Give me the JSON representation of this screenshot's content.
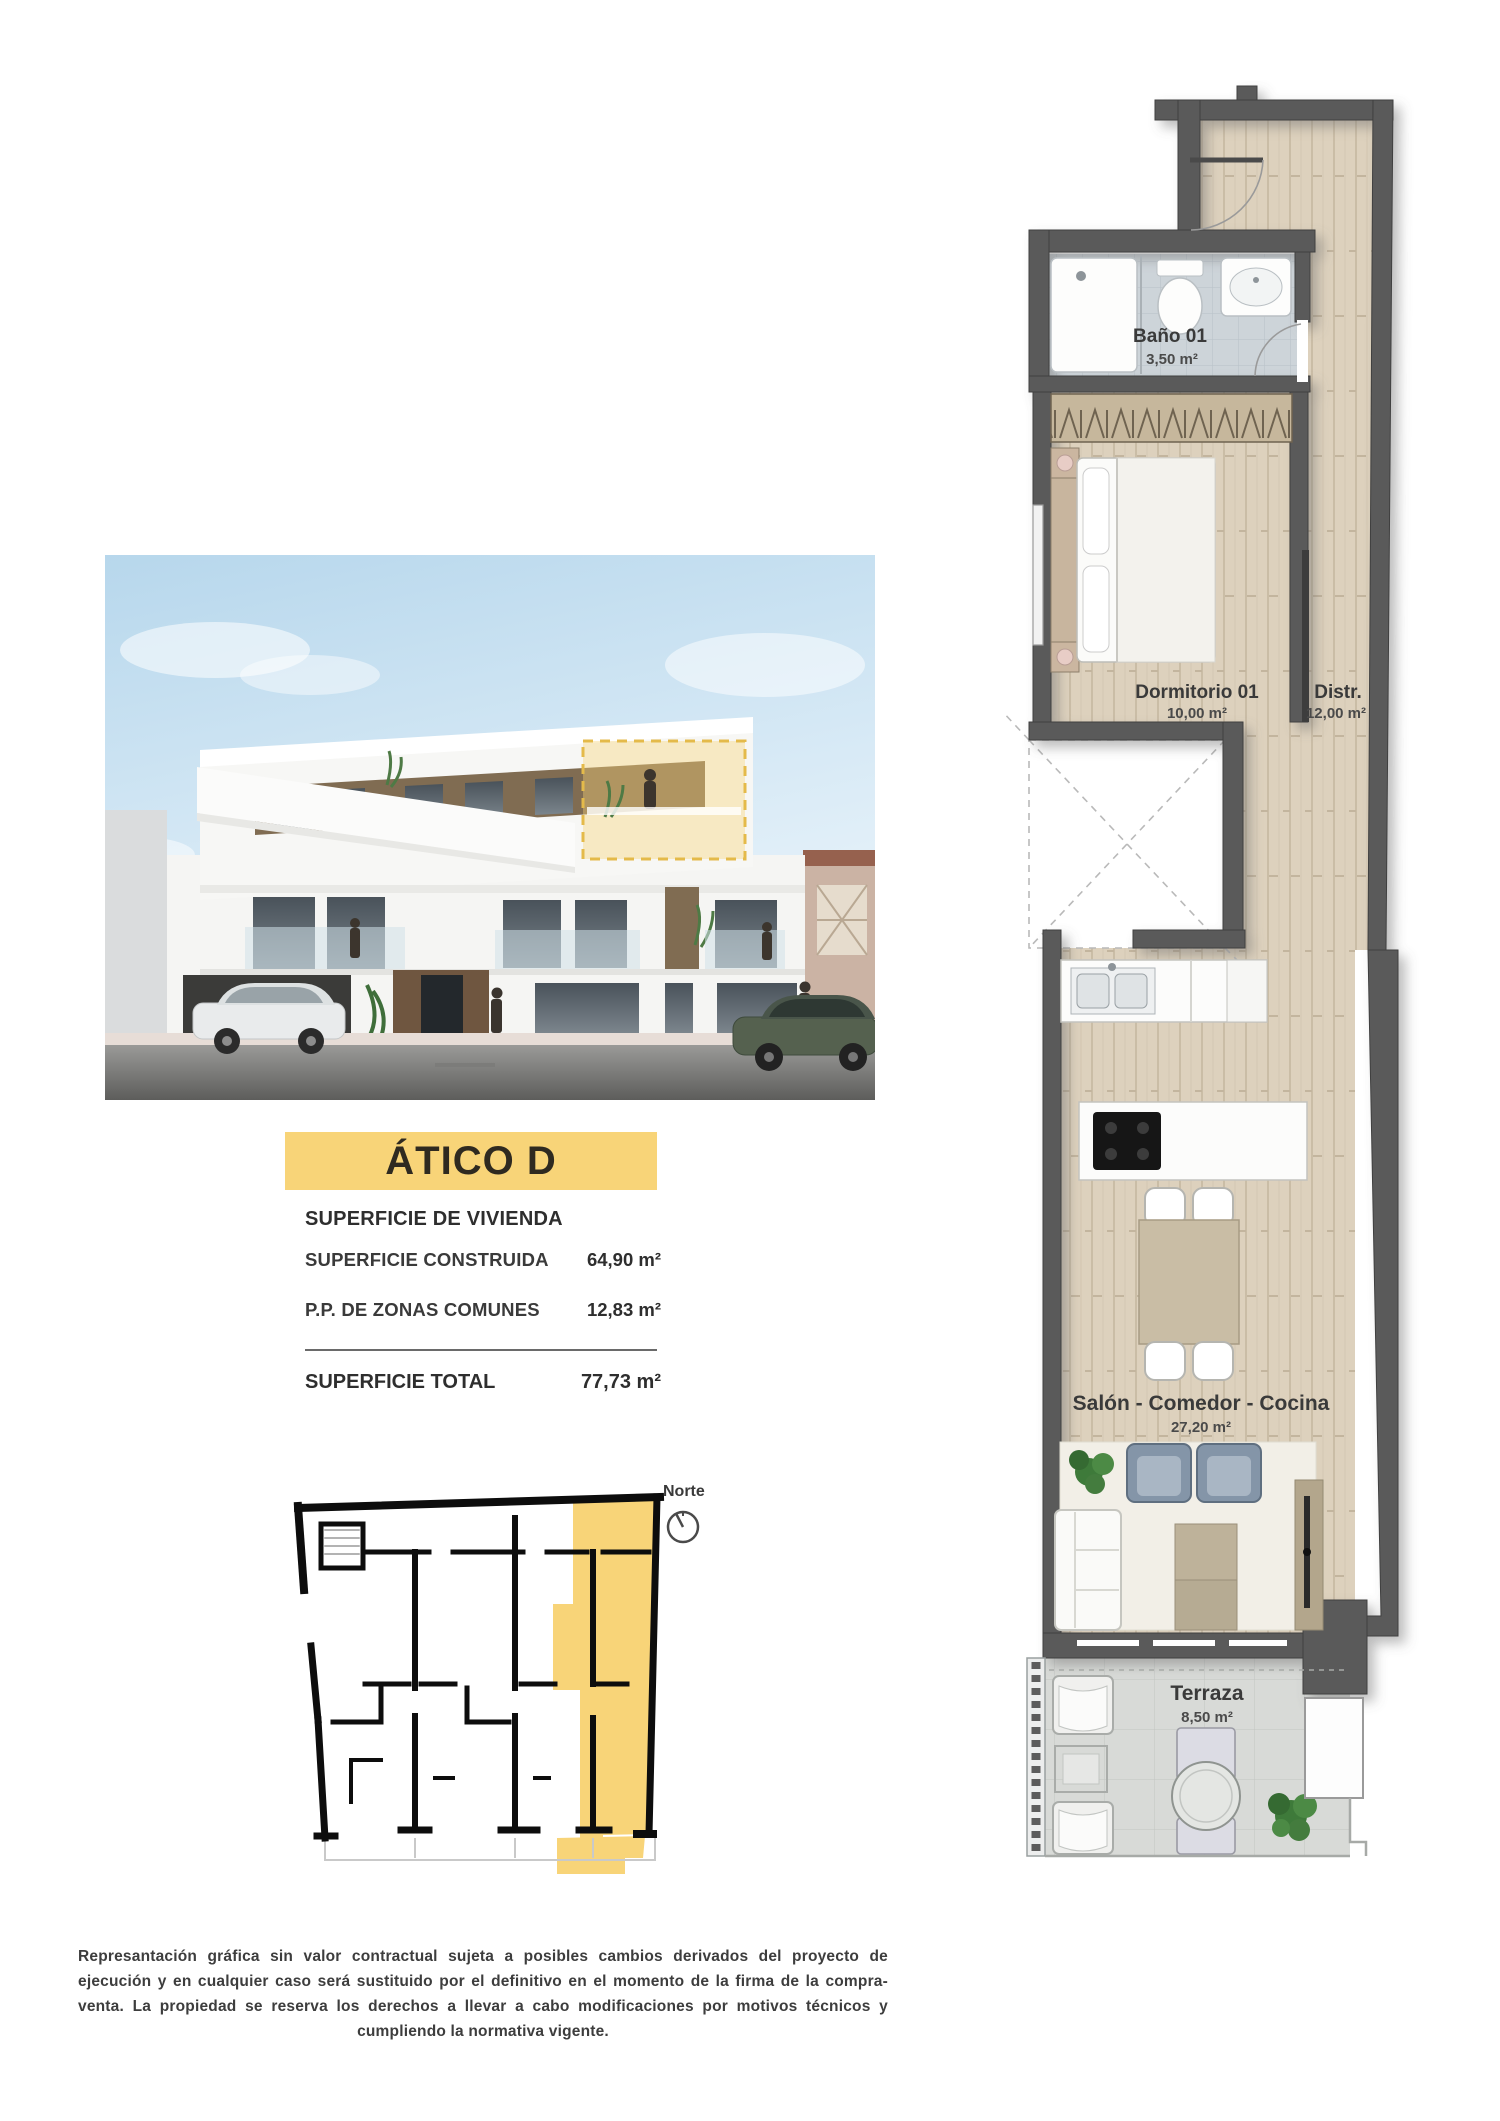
{
  "unit": {
    "title": "ÁTICO D"
  },
  "surface_table": {
    "header": "SUPERFICIE DE VIVIENDA",
    "rows": [
      {
        "label": "SUPERFICIE CONSTRUIDA",
        "value": "64,90 m²"
      },
      {
        "label": "P.P. DE ZONAS COMUNES",
        "value": "12,83 m²"
      }
    ],
    "total_label": "SUPERFICIE TOTAL",
    "total_value": "77,73 m²"
  },
  "floorplan": {
    "rooms": [
      {
        "name": "Baño 01",
        "area": "3,50 m²"
      },
      {
        "name": "Dormitorio 01",
        "area": "10,00 m²"
      },
      {
        "name": "Distr.",
        "area": "12,00 m²"
      },
      {
        "name": "Salón - Comedor - Cocina",
        "area": "27,20 m²"
      },
      {
        "name": "Terraza",
        "area": "8,50 m²"
      }
    ]
  },
  "keyplan": {
    "north_label": "Norte"
  },
  "disclaimer": "Represantación gráfica sin valor contractual sujeta a posibles cambios derivados del proyecto de ejecución y en cualquier caso será sustituido por el definitivo en el momento de la firma de la compra-venta. La propiedad se reserva los derechos a llevar a cabo modificaciones por motivos técnicos y cumpliendo la normativa vigente.",
  "colors": {
    "accent_yellow": "#f8d478",
    "wall_grey": "#5a5a5a",
    "wood_floor": "#ddd1bd",
    "bath_tile": "#cdd4d9",
    "terrace_paving": "#d8dad7",
    "sky_blue": "#b7d7ec"
  }
}
